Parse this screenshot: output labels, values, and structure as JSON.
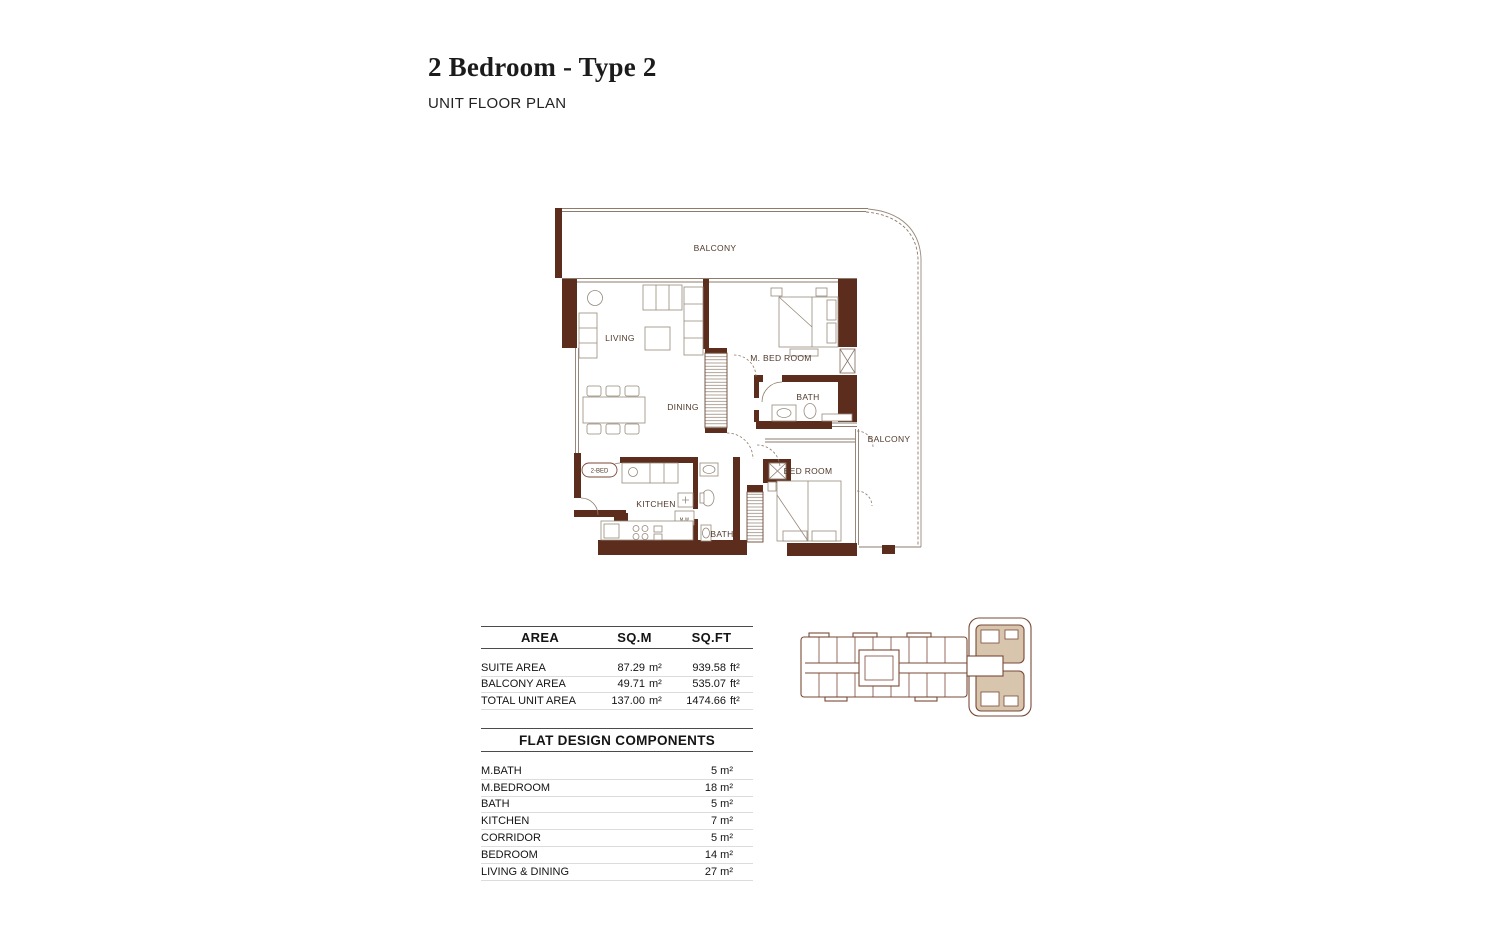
{
  "page": {
    "title": "2 Bedroom - Type 2",
    "subtitle": "UNIT FLOOR PLAN"
  },
  "floor_plan": {
    "unit_tag": "2-BED",
    "labels": {
      "balcony_top": "BALCONY",
      "living": "LIVING",
      "dining": "DINING",
      "master_bedroom": "M. BED ROOM",
      "master_bath": "BATH",
      "balcony_right": "BALCONY",
      "kitchen": "KITCHEN",
      "microwave": "M.W",
      "bath": "BATH",
      "bedroom": "BED ROOM"
    },
    "colors": {
      "wall": "#5c2d1c",
      "thin_line": "#8d7b6c",
      "label_text": "#50392b"
    }
  },
  "area_table": {
    "headers": {
      "area": "AREA",
      "sqm": "SQ.M",
      "sqft": "SQ.FT"
    },
    "rows": [
      {
        "label": "SUITE AREA",
        "sqm_value": "87.29",
        "sqm_unit": "m²",
        "sqft_value": "939.58",
        "sqft_unit": "ft²"
      },
      {
        "label": "BALCONY AREA",
        "sqm_value": "49.71",
        "sqm_unit": "m²",
        "sqft_value": "535.07",
        "sqft_unit": "ft²"
      },
      {
        "label": "TOTAL UNIT AREA",
        "sqm_value": "137.00",
        "sqm_unit": "m²",
        "sqft_value": "1474.66",
        "sqft_unit": "ft²"
      }
    ]
  },
  "components_table": {
    "title": "FLAT DESIGN COMPONENTS",
    "rows": [
      {
        "label": "M.BATH",
        "value": "5 m²"
      },
      {
        "label": "M.BEDROOM",
        "value": "18 m²"
      },
      {
        "label": "BATH",
        "value": "5 m²"
      },
      {
        "label": "KITCHEN",
        "value": "7 m²"
      },
      {
        "label": "CORRIDOR",
        "value": "5 m²"
      },
      {
        "label": "BEDROOM",
        "value": "14 m²"
      },
      {
        "label": "LIVING & DINING",
        "value": "27 m²"
      }
    ]
  },
  "key_plan": {
    "highlight_color": "#d7c5ae",
    "line_color": "#7a4a35"
  }
}
